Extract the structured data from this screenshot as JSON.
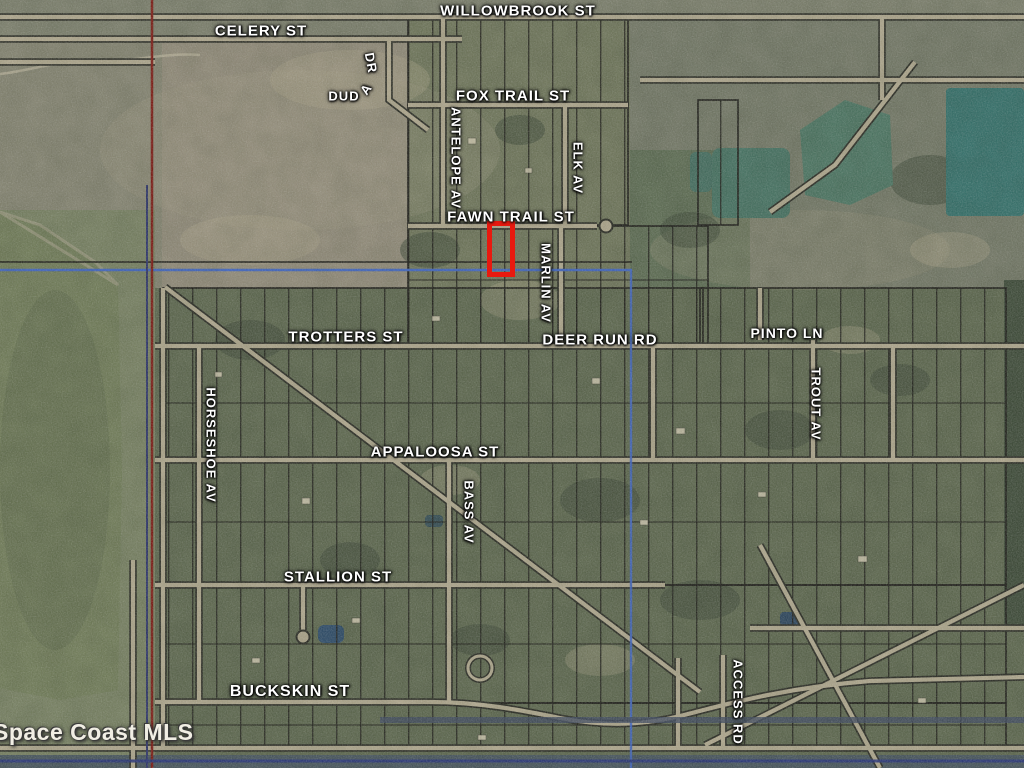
{
  "map": {
    "watermark": "Space Coast MLS",
    "highlight": {
      "x": 487,
      "y": 221,
      "width": 28,
      "height": 56,
      "label": "subject-property-outline"
    },
    "colors": {
      "highlight_red": "#e8190f",
      "boundary_red": "#7d150c",
      "boundary_navy": "#283069",
      "boundary_blue": "#3b63c4",
      "road_fill": "#b2a98e",
      "road_casing": "#23251c",
      "parcel_line": "#15150f",
      "water_teal": "#2e6e68",
      "water_marsh": "#6f7b55",
      "label_white": "#ffffff"
    },
    "street_labels": [
      {
        "id": "willowbrook-st",
        "text": "WILLOWBROOK ST",
        "x": 518,
        "y": 11,
        "rot": 0,
        "size": 15
      },
      {
        "id": "celery-st",
        "text": "CELERY ST",
        "x": 261,
        "y": 31,
        "rot": 0,
        "size": 15
      },
      {
        "id": "dud",
        "text": "DUD",
        "x": 344,
        "y": 96,
        "rot": 0,
        "size": 13
      },
      {
        "id": "dud-a",
        "text": "A",
        "x": 366,
        "y": 89,
        "rot": -55,
        "size": 13
      },
      {
        "id": "duda-dr",
        "text": "DR",
        "x": 371,
        "y": 63,
        "rot": 80,
        "size": 13
      },
      {
        "id": "fox-trail-st",
        "text": "FOX TRAIL ST",
        "x": 513,
        "y": 96,
        "rot": 0,
        "size": 15
      },
      {
        "id": "antelope-av",
        "text": "ANTELOPE AV",
        "x": 456,
        "y": 158,
        "rot": 90,
        "size": 13
      },
      {
        "id": "elk-av",
        "text": "ELK AV",
        "x": 578,
        "y": 168,
        "rot": 90,
        "size": 13
      },
      {
        "id": "fawn-trail-st",
        "text": "FAWN TRAIL ST",
        "x": 511,
        "y": 217,
        "rot": 0,
        "size": 15
      },
      {
        "id": "marlin-av",
        "text": "MARLIN AV",
        "x": 546,
        "y": 283,
        "rot": 90,
        "size": 13
      },
      {
        "id": "trotters-st",
        "text": "TROTTERS ST",
        "x": 346,
        "y": 337,
        "rot": 0,
        "size": 15
      },
      {
        "id": "deer-run-rd",
        "text": "DEER RUN RD",
        "x": 600,
        "y": 340,
        "rot": 0,
        "size": 15
      },
      {
        "id": "pinto-ln",
        "text": "PINTO LN",
        "x": 787,
        "y": 333,
        "rot": 0,
        "size": 14
      },
      {
        "id": "horseshoe-av",
        "text": "HORSESHOE AV",
        "x": 211,
        "y": 445,
        "rot": 90,
        "size": 13
      },
      {
        "id": "trout-av",
        "text": "TROUT AV",
        "x": 816,
        "y": 404,
        "rot": 90,
        "size": 13
      },
      {
        "id": "appaloosa-st",
        "text": "APPALOOSA ST",
        "x": 435,
        "y": 452,
        "rot": 0,
        "size": 15
      },
      {
        "id": "bass-av",
        "text": "BASS AV",
        "x": 469,
        "y": 512,
        "rot": 90,
        "size": 13
      },
      {
        "id": "stallion-st",
        "text": "STALLION ST",
        "x": 338,
        "y": 577,
        "rot": 0,
        "size": 15
      },
      {
        "id": "buckskin-st",
        "text": "BUCKSKIN ST",
        "x": 290,
        "y": 692,
        "rot": 0,
        "size": 16
      },
      {
        "id": "access-rd",
        "text": "ACCESS RD",
        "x": 738,
        "y": 702,
        "rot": 90,
        "size": 13
      }
    ]
  }
}
